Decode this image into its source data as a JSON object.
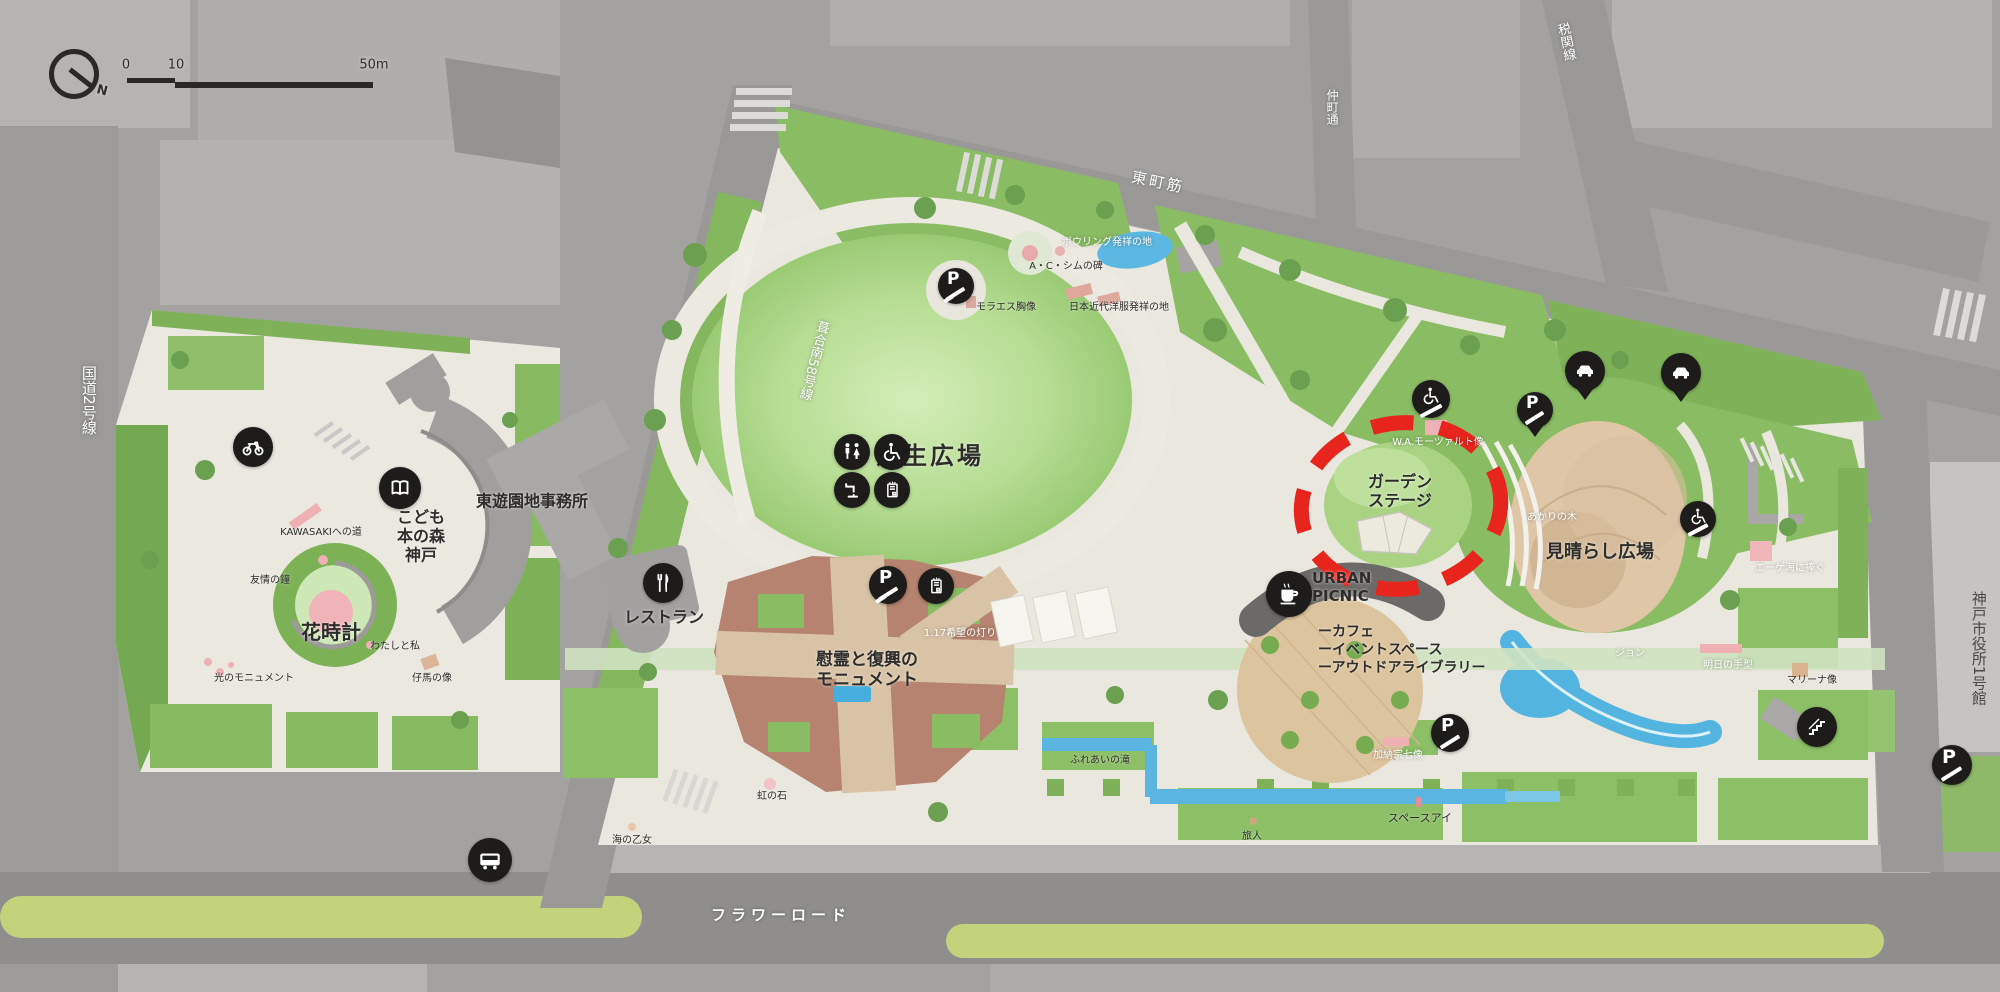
{
  "scalebar": {
    "zero": "0",
    "ten": "10",
    "fifty": "50m"
  },
  "compass": {
    "north": "N"
  },
  "streets": {
    "kokudo2": "国道2号線",
    "flower_road": "フラワーロード",
    "higashimachi": "東町筋",
    "fukiai58": "葺合南58号線",
    "nakamachi": "仲町通",
    "zeikan": "税関線",
    "shiyakusho": "神戸市役所1号館"
  },
  "areas": {
    "shibafu": "芝生広場",
    "garden_stage": "ガーデン\nステージ",
    "miharashi": "見晴らし広場",
    "hanadokei": "花時計",
    "kodomo_hon": "こども\n本の森\n神戸",
    "jimusho": "東遊園地事務所",
    "restaurant": "レストラン",
    "irei": "慰霊と復興の\nモニュメント"
  },
  "urban": {
    "name": "URBAN\nPICNIC",
    "items": [
      "ーカフェ",
      "ーイベントスペース",
      "ーアウトドアライブラリー"
    ]
  },
  "landmarks": {
    "kawasaki": "KAWASAKIへの道",
    "yujo": "友情の鐘",
    "watashi": "わたしと私",
    "kouma": "仔馬の像",
    "hikarimon": "光のモニュメント",
    "kibou": "1.17希望の灯り",
    "bowling": "ボウリング発祥の地",
    "sim": "A・C・シムの碑",
    "moraes": "モラエス胸像",
    "yofuku": "日本近代洋服発祥の地",
    "mozart": "W.A.モーツァルト像",
    "akari": "あかりの木",
    "aegean": "エーゲ海に捧ぐ",
    "asu": "明日の手型",
    "marina": "マリーナ像",
    "kanou": "加納宗七像",
    "fureai": "ふれあいの滝",
    "niji": "虹の石",
    "umi": "海の乙女",
    "tabibito": "旅人",
    "space_eye": "スペースアイ",
    "jon": "ジョン"
  },
  "icons": {
    "parking_letter": "P"
  },
  "colors": {
    "highlight_red": "#e8251d"
  }
}
